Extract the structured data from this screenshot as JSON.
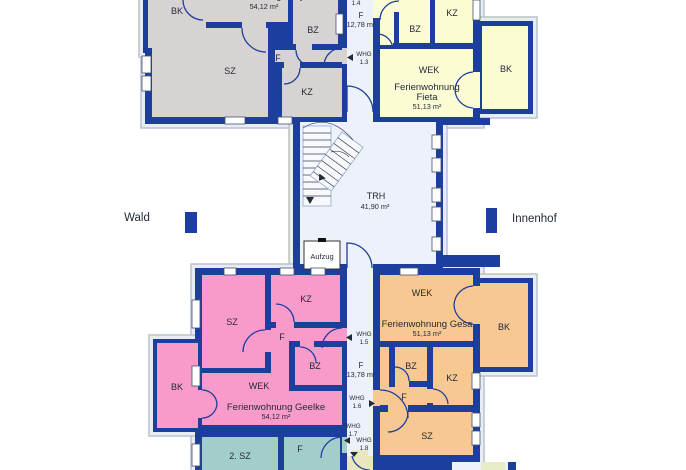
{
  "context": {
    "wald": "Wald",
    "innenhof": "Innenhof"
  },
  "stairwell": {
    "name": "TRH",
    "area": "41,90 m²",
    "elevator_label": "Aufzug"
  },
  "corridor_upper": {
    "whg_14_line1": "WHG",
    "whg_14_line2": "1.4",
    "hall_label": "F",
    "hall_area": "12,78 m²",
    "whg_13_line1": "WHG",
    "whg_13_line2": "1.3"
  },
  "corridor_lower": {
    "whg_15_line1": "WHG",
    "whg_15_line2": "1.5",
    "hall_label": "F",
    "hall_area": "13,78 m²",
    "whg_16_line1": "WHG",
    "whg_16_line2": "1.6",
    "whg_17_line1": "WHG",
    "whg_17_line2": "1.7",
    "whg_18_line1": "WHG",
    "whg_18_line2": "1.8"
  },
  "apartment_fenja": {
    "title": "Ferienwohnung Fenja",
    "area": "54,12 m²",
    "room_bk": "BK",
    "room_sz": "SZ",
    "room_f": "F",
    "room_kz": "KZ",
    "room_bz": "BZ"
  },
  "apartment_fieta": {
    "title_line1": "Ferienwohnung",
    "title_line2": "Fieta",
    "area": "51,13 m²",
    "room_kz": "KZ",
    "room_bz": "BZ",
    "room_wek": "WEK",
    "room_bk": "BK"
  },
  "apartment_geelke": {
    "title": "Ferienwohnung Geelke",
    "area": "54,12 m²",
    "room_kz": "KZ",
    "room_sz": "SZ",
    "room_f": "F",
    "room_bz": "BZ",
    "room_bk": "BK",
    "room_wek": "WEK"
  },
  "apartment_gesa": {
    "title": "Ferienwohnung Gesa",
    "area": "51,13 m²",
    "room_wek": "WEK",
    "room_bk": "BK",
    "room_bz": "BZ",
    "room_kz": "KZ",
    "room_f": "F",
    "room_sz": "SZ"
  },
  "apartment_lower_partial": {
    "room_sz2": "2. SZ",
    "room_f": "F"
  },
  "colors": {
    "wall": "#1c3f9e",
    "floor": "#edf1f9",
    "outline": "#b9c2cf",
    "fenja_gray": "#d7d3d3",
    "fieta_yellow": "#fcfcd4",
    "geelke_pink": "#f99bca",
    "gesa_orange": "#f7c891",
    "partial_teal": "#a2cdc8",
    "hall_beige": "#eae6bd",
    "text": "#222a38"
  }
}
